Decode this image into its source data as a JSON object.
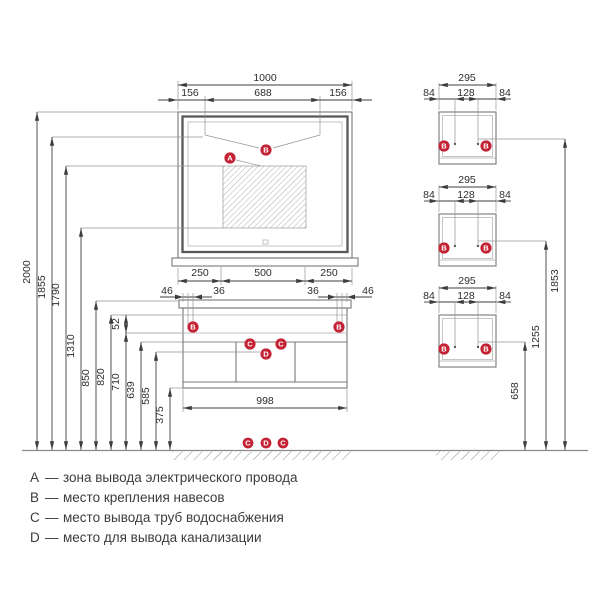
{
  "colors": {
    "marker": "#c32334"
  },
  "markers": {
    "a": "A",
    "b": "B",
    "c": "C",
    "d": "D"
  },
  "mirror": {
    "dim_total": "1000",
    "dim_left": "156",
    "dim_center": "688",
    "dim_right": "156",
    "dim_bottom_left": "250",
    "dim_bottom_center": "500",
    "dim_bottom_right": "250"
  },
  "vanity": {
    "dim_edge_left": "46",
    "dim_inner_left": "36",
    "dim_inner_right": "36",
    "dim_edge_right": "46",
    "dim_rail": "52",
    "dim_width": "998"
  },
  "left_heights": {
    "h2000": "2000",
    "h1855": "1855",
    "h1790": "1790",
    "h1310": "1310",
    "h850": "850",
    "h820": "820",
    "h710": "710",
    "h639": "639",
    "h585": "585",
    "h375": "375"
  },
  "wall_cabinet": {
    "dim_width": "295",
    "dim_side": "84",
    "dim_center": "128"
  },
  "right_heights": {
    "top": "1853",
    "middle": "1255",
    "bottom": "658"
  },
  "legend": {
    "separator": "—",
    "items": [
      {
        "key": "A",
        "text": "зона вывода электрического провода"
      },
      {
        "key": "B",
        "text": "место крепления навесов"
      },
      {
        "key": "C",
        "text": "место вывода труб водоснабжения"
      },
      {
        "key": "D",
        "text": "место для вывода канализации"
      }
    ]
  }
}
